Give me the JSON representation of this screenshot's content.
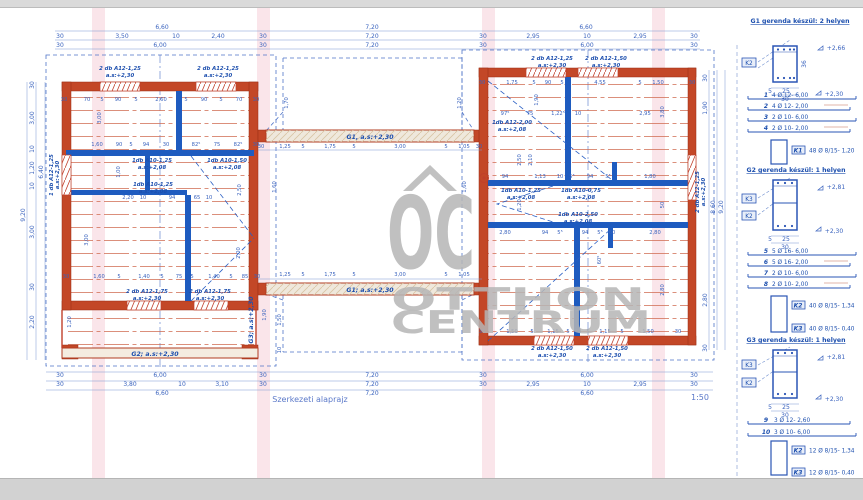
{
  "footer": {
    "title": "Szerkezeti alaprajz",
    "scale": "1:50"
  },
  "watermark": {
    "oc": "OC",
    "line1": "OTTHON",
    "line2": "CENTRUM"
  },
  "colors": {
    "wall_red": "#c34727",
    "structure_blue": "#1e5bbf",
    "dim_blue": "#3a63be",
    "hatch_red": "#cf6a50",
    "grid_pink": "#f6ccd6",
    "watermark_gray": "#b6b6b6"
  },
  "beams": {
    "g1_top": "G1, a.s:+2,30",
    "g1_bottom": "G1; a.s:+2,30",
    "g2": "G2; a.s:+2,30",
    "g3": "G3; a.s:+2,30"
  },
  "lintels": {
    "lt_left": [
      "2 db A12-1,25",
      "a.s:+2,30"
    ],
    "lt_right": [
      "2 db A12-1,25",
      "a.s:+2,30"
    ],
    "lb_left": [
      "2 db A12-1,75",
      "a.s:+2,30"
    ],
    "lb_right": [
      "2 db A12-1,75",
      "a.s:+2,30"
    ],
    "l_side": [
      "1 db A12-1,25",
      "a.s:+2,30"
    ],
    "rt_left": [
      "2 db A12-1,25",
      "a.s:+2,30"
    ],
    "rt_right": [
      "2 db A12-1,50",
      "a.s:+2,30"
    ],
    "rb_left": [
      "2 db A12-1,50",
      "a.s:+2,30"
    ],
    "rb_right": [
      "2 db A12-1,50",
      "a.s:+2,30"
    ],
    "r_side": [
      "2 db A12-1,25",
      "a.s:+2,30"
    ],
    "li_1": [
      "1db A10-1,25",
      "a.s:+2,08"
    ],
    "li_2": [
      "1db A10-1,50",
      "a.s:+2,08"
    ],
    "li_3": [
      "1db A10-1,25",
      "a.s:+2,08"
    ],
    "ri_1": [
      "1db A12-2,00",
      "a.s:+2,08"
    ],
    "ri_2": [
      "1db A10-1,25",
      "a.s:+2,08"
    ],
    "ri_3": [
      "1db A10-0,75",
      "a.s:+2,08"
    ],
    "ri_4": [
      "1db A10-2,50",
      "a.s:+2,08"
    ]
  },
  "dims": {
    "top_left": [
      "6,60",
      "30",
      "3,50",
      "10",
      "2,40",
      "30",
      "30",
      "6,00",
      "30"
    ],
    "top_mid": [
      "7,20",
      "7,20",
      "7,20"
    ],
    "top_right": [
      "6,60",
      "30",
      "2,95",
      "10",
      "2,95",
      "30",
      "30",
      "6,00",
      "30"
    ],
    "bot_left": [
      "30",
      "6,00",
      "30",
      "30",
      "3,80",
      "10",
      "3,10",
      "30",
      "6,60"
    ],
    "bot_mid": [
      "7,20",
      "7,20",
      "7,20"
    ],
    "bot_right": [
      "30",
      "6,00",
      "30",
      "30",
      "2,95",
      "10",
      "2,95",
      "30",
      "6,60"
    ],
    "left_v": [
      "30",
      "3,00",
      "10",
      "1,20",
      "10",
      "3,00",
      "30",
      "2,20",
      "6,40",
      "9,20"
    ],
    "right_v": [
      "30",
      "1,90",
      "8,60",
      "9,20",
      "2,80",
      "30"
    ],
    "corridor_top": [
      "30",
      "1,25",
      "5",
      "1,75",
      "5",
      "3,00",
      "5",
      "1,05",
      "30"
    ],
    "corridor_bot": [
      "1,25",
      "5",
      "1,75",
      "5",
      "3,00",
      "5",
      "1,05"
    ],
    "corridor_v": [
      "1,70",
      "1,20",
      "1,60",
      "1,60",
      "1,50",
      "10"
    ],
    "lb_r1": [
      "30",
      "70",
      "5",
      "90",
      "5",
      "2,60",
      "5",
      "90",
      "5",
      "70",
      "30"
    ],
    "lb_r2": [
      "1,60",
      "90",
      "5",
      "94",
      "30",
      "82⁵",
      "75",
      "82⁵",
      "30"
    ],
    "lb_r3": [
      "2,20",
      "10",
      "94",
      "65",
      "10"
    ],
    "lb_r4": [
      "30",
      "1,60",
      "5",
      "1,40",
      "5",
      "75",
      "5",
      "1,40",
      "5",
      "85",
      "30"
    ],
    "lb_v": [
      "3,00",
      "1,00",
      "2,50",
      "3,00",
      "2,00",
      "1,20",
      "1,90"
    ],
    "rb_r1": [
      "30",
      "1,75",
      "5",
      "90",
      "5",
      "4,55",
      "5",
      "1,50",
      "30"
    ],
    "rb_r2": [
      "97⁵",
      "75",
      "1,22⁵",
      "10",
      "2,95"
    ],
    "rb_r3": [
      "94",
      "1,13",
      "10",
      "5⁵",
      "94",
      "5⁵",
      "1,80"
    ],
    "rb_r4": [
      "2,80",
      "94",
      "5⁵",
      "94",
      "5⁵",
      "60",
      "2,80"
    ],
    "rb_r5": [
      "30",
      "1,50",
      "5",
      "1,15",
      "5",
      "10",
      "5",
      "1,15",
      "5",
      "1,50",
      "30"
    ],
    "rb_v": [
      "1,90",
      "2,50",
      "2,10",
      "1,20",
      "50",
      "60⁵",
      "2,80",
      "3,80"
    ]
  },
  "sidebar": {
    "g1": {
      "title": "G1 gerenda készül: 2 helyen",
      "elev_top": "+2,66",
      "elev_bot": "+2,30",
      "k_left": "K2",
      "d5": "5",
      "d25": "25",
      "d30": "30",
      "height": "36",
      "bars": [
        {
          "n": "1",
          "t": "4 Ø 12- 6,00"
        },
        {
          "n": "2",
          "t": "4 Ø 12- 2,00"
        },
        {
          "n": "3",
          "t": "2 Ø 10- 6,00"
        },
        {
          "n": "4",
          "t": "2 Ø 10- 2,00"
        }
      ],
      "stirrups": [
        {
          "n": "K1",
          "t": "48 Ø 8/15- 1,20"
        }
      ]
    },
    "g2": {
      "title": "G2 gerenda készül: 1 helyen",
      "elev_top": "+2,81",
      "elev_bot": "+2,30",
      "k_top": "K3",
      "k_bot": "K2",
      "d5": "5",
      "d25": "25",
      "d30": "30",
      "bars": [
        {
          "n": "5",
          "t": "5 Ø 16- 6,00"
        },
        {
          "n": "6",
          "t": "5 Ø 16- 2,00"
        },
        {
          "n": "7",
          "t": "2 Ø 10- 6,00"
        },
        {
          "n": "8",
          "t": "2 Ø 10- 2,00"
        }
      ],
      "stirrups": [
        {
          "n": "K2",
          "t": "40 Ø 8/15- 1,34"
        },
        {
          "n": "K3",
          "t": "40 Ø 8/15- 0,40"
        }
      ]
    },
    "g3": {
      "title": "G3 gerenda készül: 1 helyen",
      "elev_top": "+2,81",
      "elev_bot": "+2,30",
      "k_top": "K3",
      "k_bot": "K2",
      "d5": "5",
      "d25": "25",
      "d30": "30",
      "bars": [
        {
          "n": "9",
          "t": "3 Ø 12- 2,60"
        },
        {
          "n": "10",
          "t": "3 Ø 10- 6,00"
        }
      ],
      "stirrups": [
        {
          "n": "K2",
          "t": "12 Ø 8/15- 1,34"
        },
        {
          "n": "K3",
          "t": "12 Ø 8/15- 0,40"
        }
      ]
    }
  }
}
